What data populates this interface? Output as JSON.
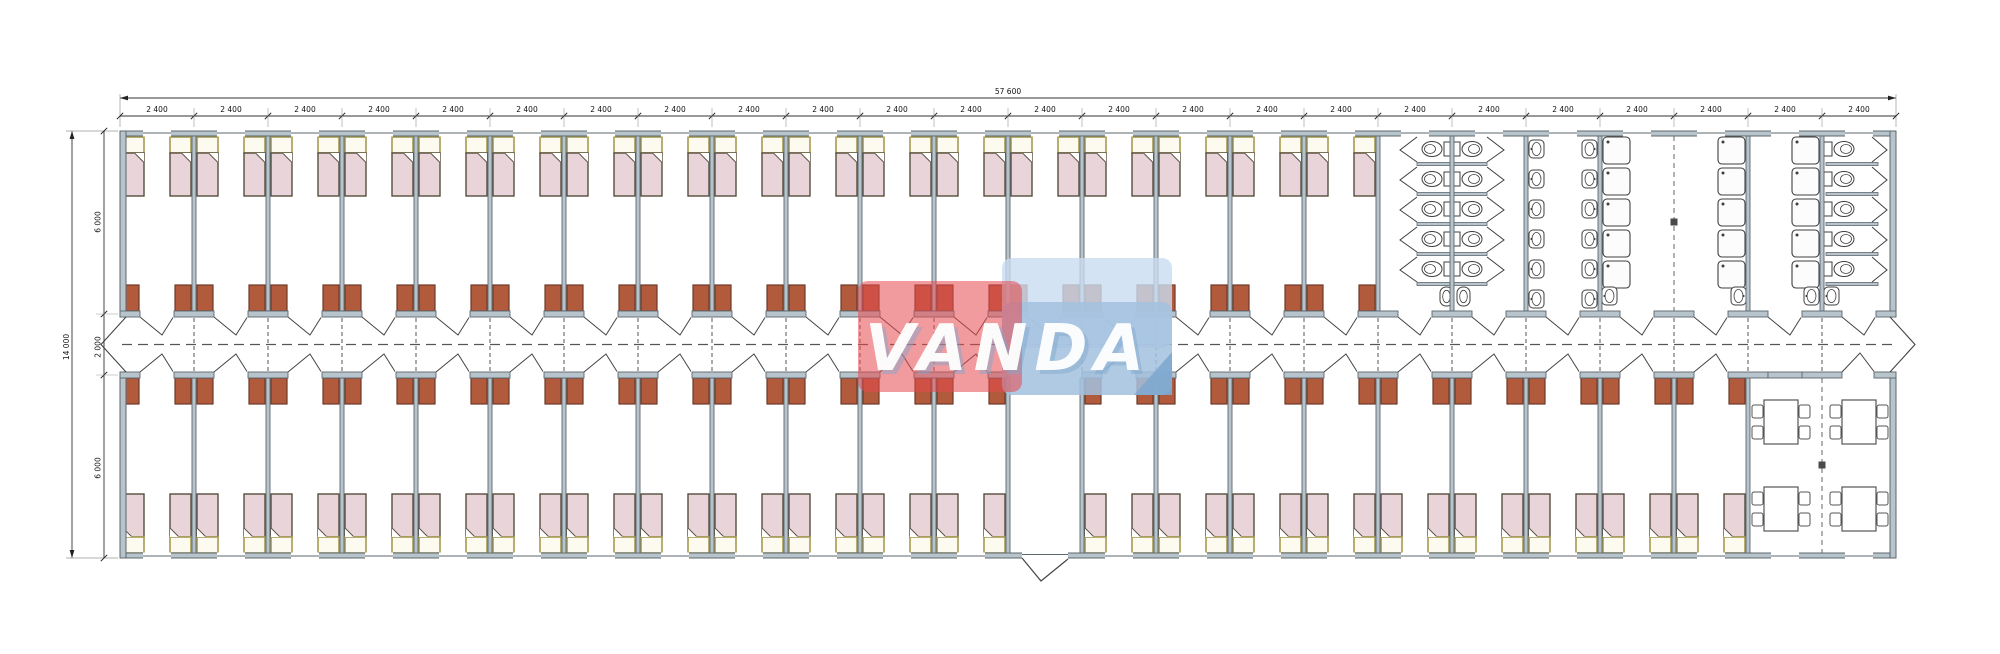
{
  "drawing": {
    "type": "floor-plan",
    "description": "Long modular dormitory building plan with central corridor, bedroom modules, sanitary block and dining room"
  },
  "dimensions": {
    "overall_width_label": "57 600",
    "module_width_label": "2 400",
    "module_count": 24,
    "overall_depth_label": "14 000",
    "depth_segment_labels": [
      "6 000",
      "2 000",
      "6 000"
    ]
  },
  "logo": {
    "text": "VANDA",
    "red": "#e8494f",
    "blue_light": "#c9dcf0",
    "blue": "#a3c1de",
    "blue_dark": "#7fa8cf",
    "text_color": "#ffffff"
  },
  "rooms": {
    "top_bedrooms": 17,
    "bottom_bedrooms": 21,
    "entrance_module_index": 13,
    "dining_module_count": 2,
    "beds_per_room": 2,
    "wardrobes_per_room": 2,
    "dining_tables": 4,
    "chairs_per_table": 4,
    "sanitary": {
      "wc_stall_rows": 5,
      "sink_rows": 6,
      "shower_rows": 5,
      "shower_columns": 3,
      "end_wc_stalls": 5
    }
  },
  "colors": {
    "wall_fill": "#b7c4cb",
    "wall_stroke": "#5d686e",
    "line": "#444444",
    "thin": "#8a8a8a",
    "dashed": "#555555",
    "bed_fill": "#e9d5d9",
    "bed_stroke": "#554e3d",
    "pillow_fill": "#fdfbf0",
    "pillow_stroke": "#a79b52",
    "wardrobe_fill": "#b15b3c",
    "wardrobe_stroke": "#6d3a28",
    "fixture_stroke": "#3f3f3f",
    "dim_text": "#111111"
  }
}
